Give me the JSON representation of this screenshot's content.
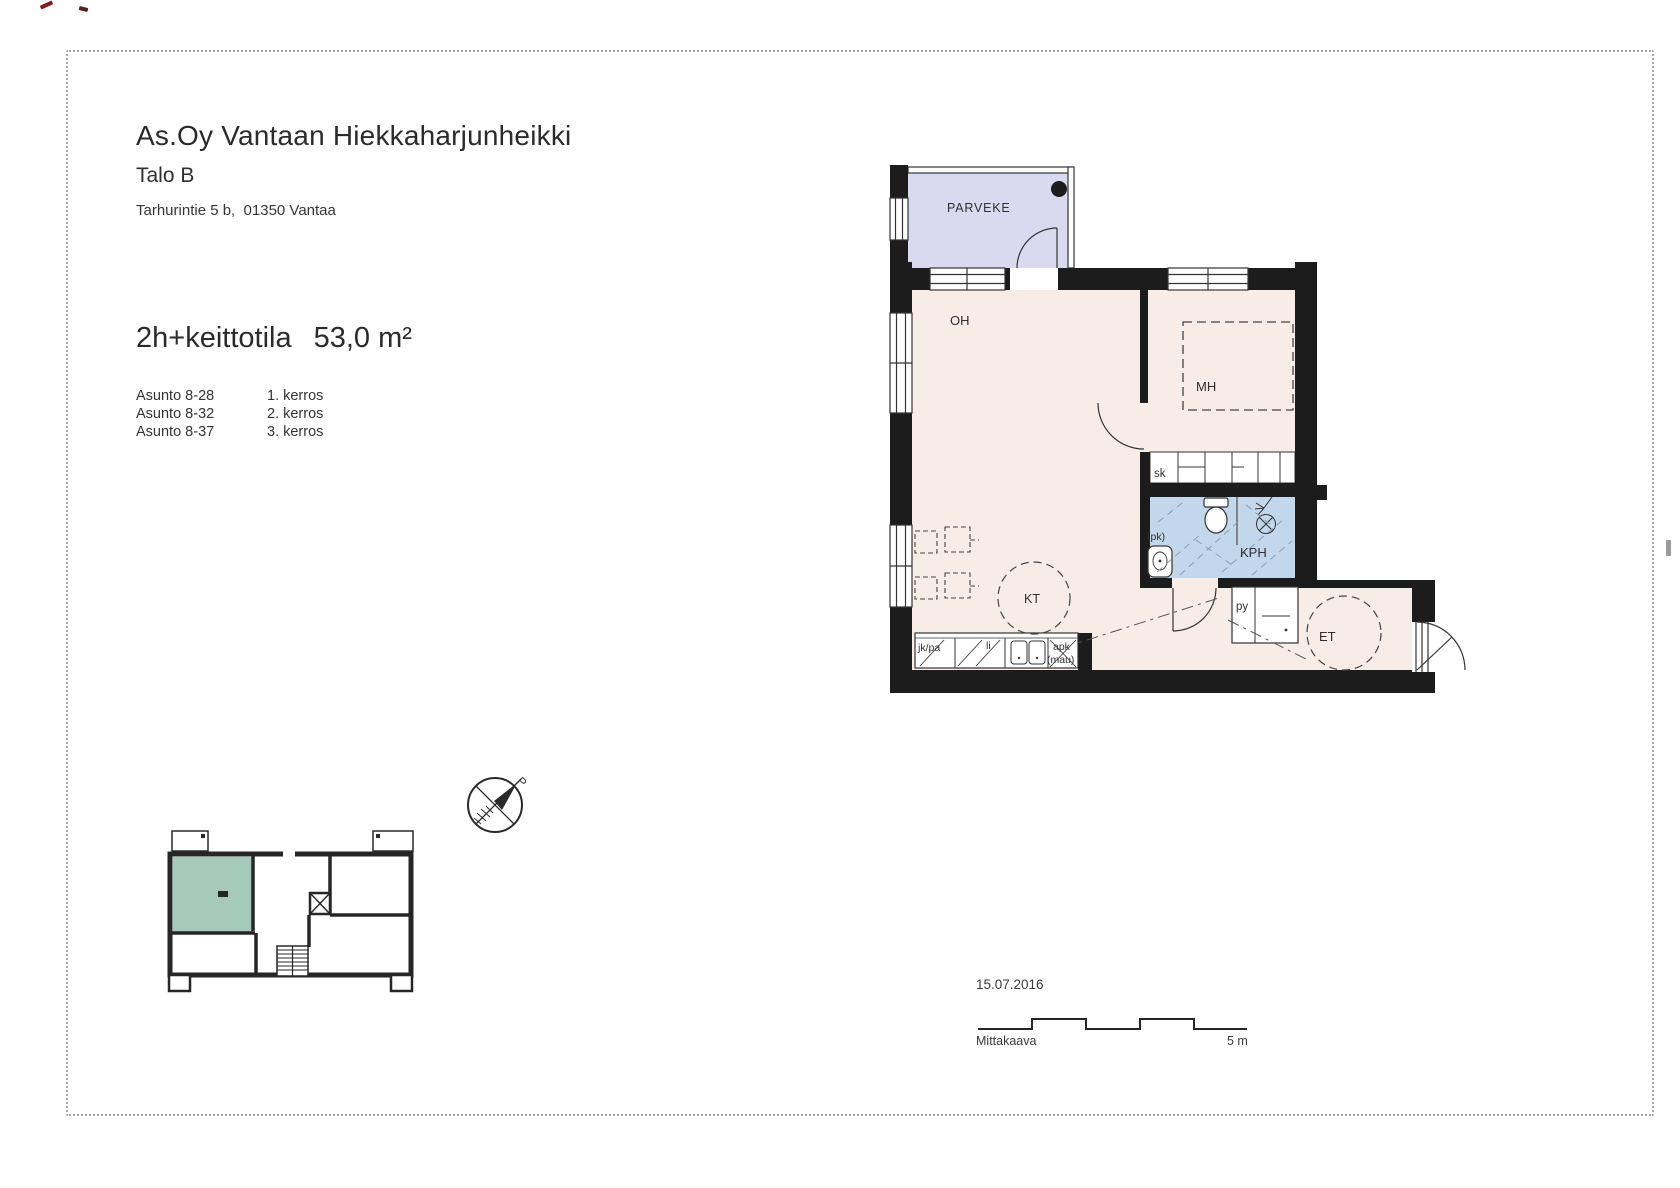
{
  "header": {
    "title": "As.Oy Vantaan Hiekkaharjunheikki",
    "building": "Talo B",
    "address": "Tarhurintie 5 b,  01350 Vantaa"
  },
  "apartment": {
    "type": "2h+keittotila",
    "area": "53,0 m²"
  },
  "units": [
    {
      "name": "Asunto 8-28",
      "floor": "1. kerros"
    },
    {
      "name": "Asunto 8-32",
      "floor": "2. kerros"
    },
    {
      "name": "Asunto 8-37",
      "floor": "3. kerros"
    }
  ],
  "plan": {
    "balcony": "PARVEKE",
    "living_room": "OH",
    "bedroom": "MH",
    "closet": "sk",
    "bathroom": "KPH",
    "washer_reservation": "(pk)",
    "linen_cupboard": "py",
    "entry": "ET",
    "kitchen": "KT",
    "fridge_freezer": "jk/pa",
    "stove": "li",
    "dishwasher_reservation": "apk",
    "dishwasher_reservation2": "(mau)"
  },
  "compass": {
    "north": "P"
  },
  "footer": {
    "date": "15.07.2016",
    "scale_label": "Mittakaava",
    "scale_length": "5 m"
  },
  "colors": {
    "wall": "#1c1c1c",
    "interior": "#f8ece6",
    "balcony": "#d9daf0",
    "bathroom": "#c3d7ec",
    "highlight": "#a5cabb"
  }
}
